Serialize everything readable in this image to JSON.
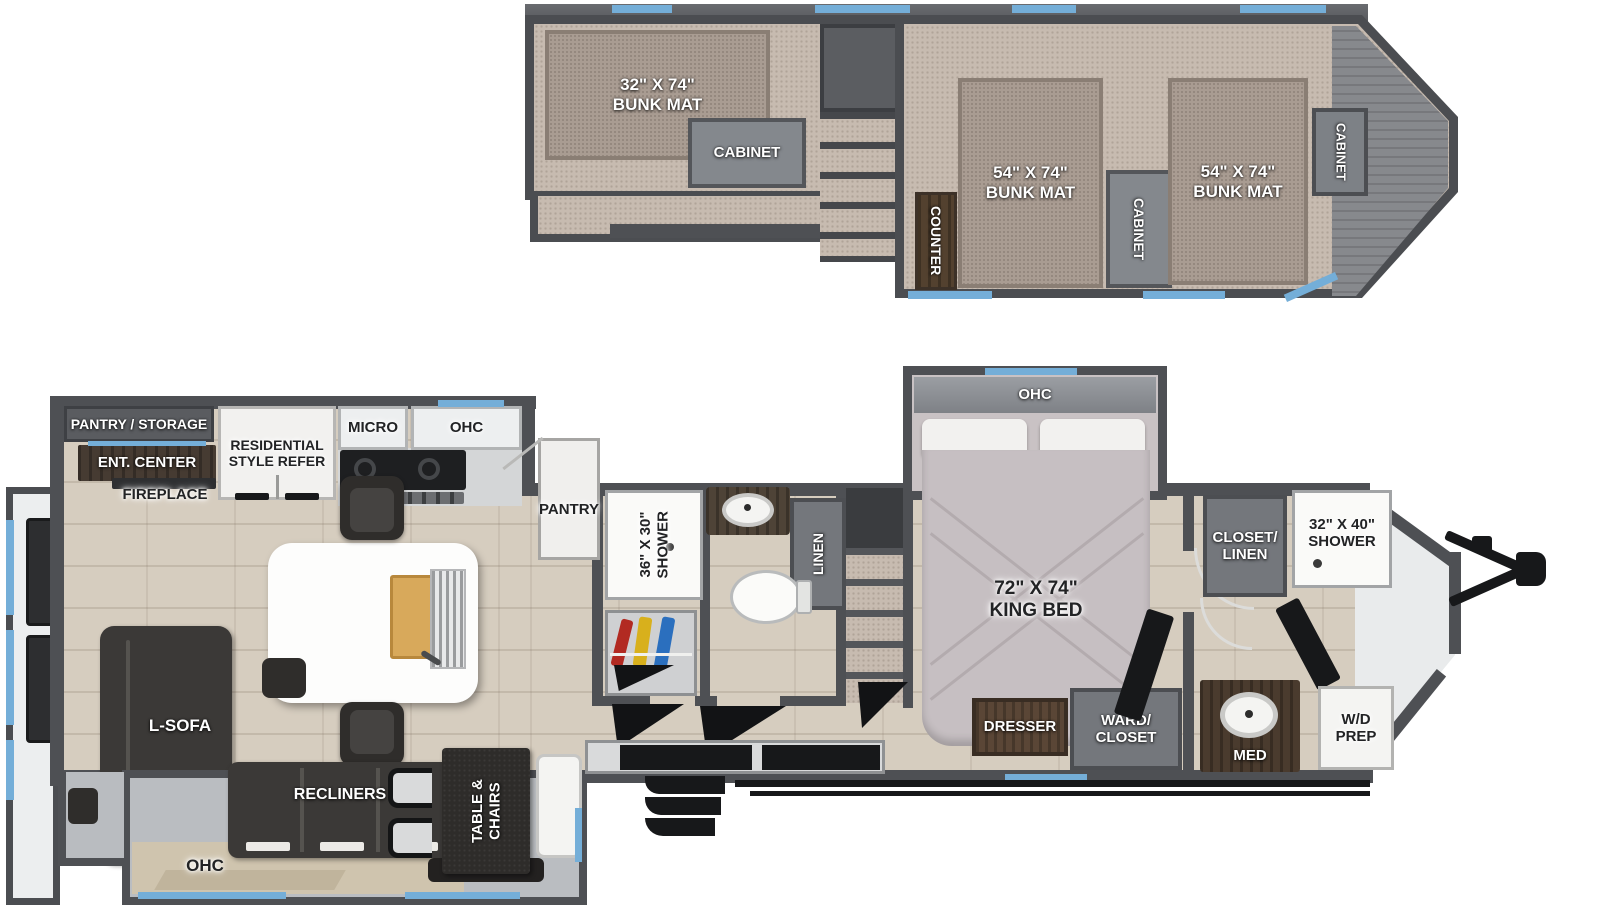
{
  "upper_floor": {
    "bunk_left": "32\" X 74\"\nBUNK MAT",
    "cabinet_left": "CABINET",
    "counter": "COUNTER",
    "bunk_mid": "54\" X 74\"\nBUNK MAT",
    "cabinet_mid": "CABINET",
    "bunk_right": "54\" X 74\"\nBUNK MAT",
    "cabinet_front": "CABINET"
  },
  "main_floor": {
    "kitchen": {
      "pantry_storage": "PANTRY / STORAGE",
      "ent_center": "ENT. CENTER",
      "fireplace": "FIREPLACE",
      "refer": "RESIDENTIAL\nSTYLE REFER",
      "micro": "MICRO",
      "ohc": "OHC",
      "pantry": "PANTRY"
    },
    "living": {
      "l_sofa": "L-SOFA",
      "recliners": "RECLINERS",
      "ohc": "OHC",
      "table_chairs": "TABLE &\nCHAIRS"
    },
    "bath_mid": {
      "shower": "36\" X 30\"\nSHOWER",
      "linen": "LINEN"
    },
    "bedroom": {
      "ohc": "OHC",
      "king_bed": "72\" X 74\"\nKING BED",
      "dresser": "DRESSER",
      "ward_closet": "WARD/\nCLOSET"
    },
    "bath_front": {
      "closet_linen": "CLOSET/\nLINEN",
      "shower": "32\" X 40\"\nSHOWER",
      "wd_prep": "W/D\nPREP",
      "med": "MED"
    }
  }
}
